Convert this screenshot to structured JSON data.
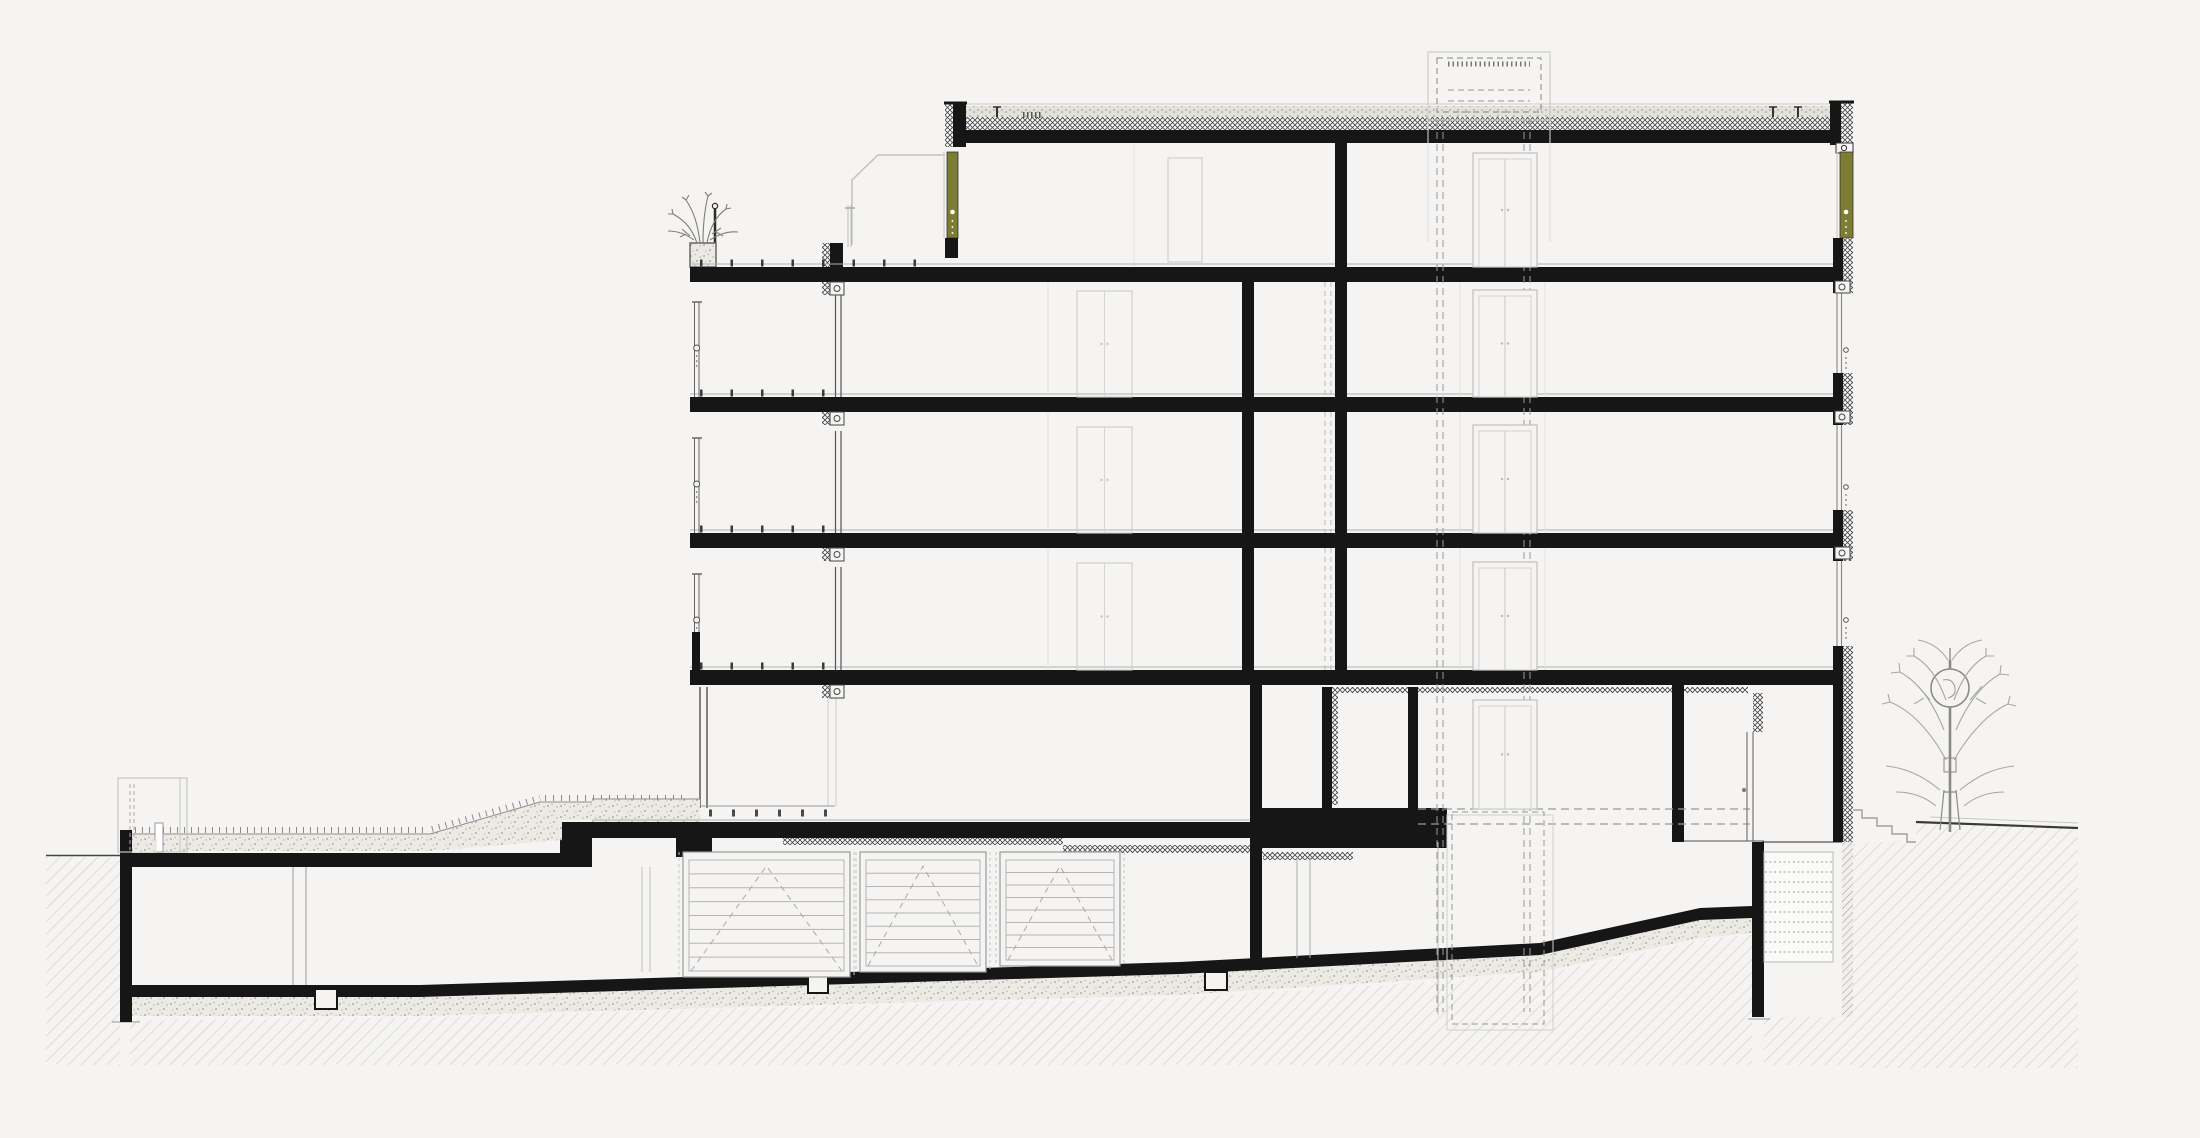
{
  "title": "Architectural building cross-section drawing",
  "colors": {
    "background": "#f5f4f2",
    "ink": "#161616",
    "olive": "#7d7c33",
    "light_line": "#c4c4c4",
    "mid_line": "#888888",
    "soil_line": "#cbc9c5",
    "stipple_bg": "#eceae5"
  },
  "counts": {
    "above_ground_floors": 5,
    "garage_doors": 3,
    "balcony_levels": 3
  },
  "floors": {
    "slab_tops": [
      267,
      397,
      533,
      670
    ],
    "slab_h": 15,
    "left_x": 690,
    "right_x": 1853,
    "finish_line_ys": [
      264,
      394,
      530,
      667
    ],
    "pedestal_rows": [
      {
        "y": 263,
        "x1": 700,
        "x2": 938
      },
      {
        "y": 393,
        "x1": 700,
        "x2": 830
      },
      {
        "y": 529,
        "x1": 700,
        "x2": 830
      },
      {
        "y": 666,
        "x1": 700,
        "x2": 830
      }
    ]
  },
  "left_facade": {
    "blind_box_ys": [
      282,
      412,
      548,
      685
    ],
    "window_spans": [
      [
        295,
        397
      ],
      [
        431,
        533
      ],
      [
        567,
        670
      ]
    ],
    "ground_window_span": [
      698,
      806
    ],
    "rail_spans": [
      [
        302,
        397
      ],
      [
        438,
        533
      ],
      [
        574,
        632
      ]
    ],
    "rail_circle_offset": 46,
    "parapet": {
      "x": 692,
      "y": 632,
      "w": 8,
      "h": 38
    }
  },
  "right_facade": {
    "spandrels": [
      {
        "y": 238,
        "h": 55
      },
      {
        "y": 373,
        "h": 52
      },
      {
        "y": 510,
        "h": 51
      },
      {
        "y": 646,
        "h": 52
      },
      {
        "y": 698,
        "h": 144
      }
    ],
    "window_spans": [
      [
        293,
        373
      ],
      [
        425,
        510
      ],
      [
        561,
        646
      ]
    ],
    "window_dot_ys": [
      350,
      487,
      620
    ],
    "head_box_ys": [
      281,
      411,
      547
    ]
  },
  "interior_walls": {
    "wall_a_x": 1242,
    "wall_a_spans": [
      [
        282,
        397
      ],
      [
        412,
        533
      ],
      [
        548,
        670
      ]
    ],
    "wall_b_x": 1335,
    "wall_b_spans": [
      [
        143,
        267
      ],
      [
        282,
        397
      ],
      [
        412,
        533
      ],
      [
        548,
        670
      ]
    ],
    "duct_dash_xs": [
      1325,
      1331
    ],
    "duct_spans": [
      [
        282,
        397
      ],
      [
        412,
        533
      ],
      [
        548,
        670
      ]
    ],
    "faint_xs": [
      1048,
      1460,
      1545
    ]
  },
  "elevator": {
    "shaft_dash_xs": [
      1437,
      1443,
      1524,
      1530
    ],
    "shaft_top": 120,
    "shaft_bottom": 1012,
    "door_x": 1473,
    "door_w": 64,
    "doors": [
      {
        "top": 153,
        "bottom": 267
      },
      {
        "top": 290,
        "bottom": 397
      },
      {
        "top": 425,
        "bottom": 533
      },
      {
        "top": 562,
        "bottom": 670
      },
      {
        "top": 700,
        "bottom": 809
      }
    ]
  },
  "apartment_doors": {
    "x": 1077,
    "w": 55,
    "doors": [
      {
        "top": 291,
        "bottom": 397
      },
      {
        "top": 427,
        "bottom": 533
      },
      {
        "top": 563,
        "bottom": 670
      }
    ]
  },
  "garage": {
    "door_top": 852,
    "doors": [
      {
        "x": 683,
        "w": 167,
        "bottom": 977
      },
      {
        "x": 860,
        "w": 126,
        "bottom": 972
      },
      {
        "x": 1000,
        "w": 120,
        "bottom": 966
      }
    ],
    "slat_count": 7
  },
  "roof": {
    "anchor_xs": [
      997,
      1773,
      1798
    ],
    "serration": {
      "x1": 1023,
      "x2": 1041,
      "y": 115
    }
  }
}
